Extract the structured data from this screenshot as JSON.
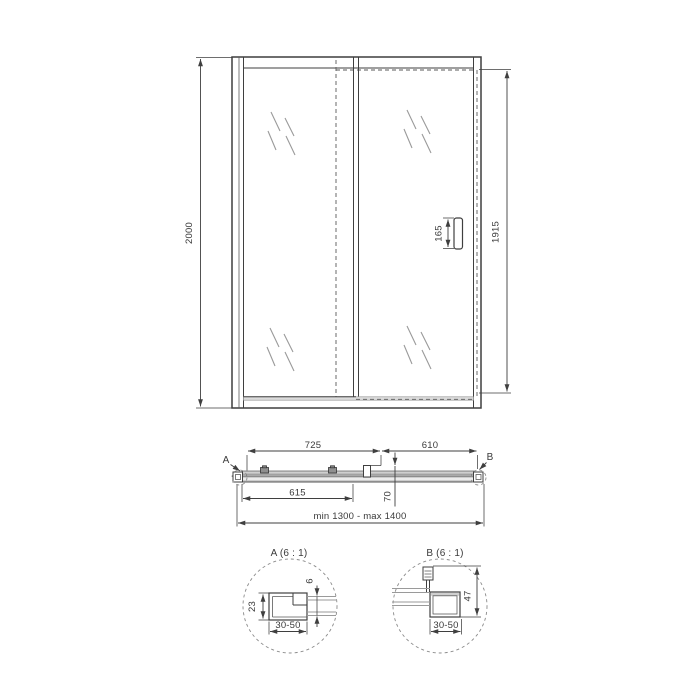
{
  "title": "Sliding shower door in niche — dimensional technical drawing",
  "colors": {
    "background": "#ffffff",
    "line": "#3f3f3f",
    "glass_hatch": "#9a9a9a",
    "fill_light_gray": "#cfcfcf"
  },
  "front": {
    "overall_height": "2000",
    "door_height": "1915",
    "handle_length": "165"
  },
  "plan": {
    "span_left": "725",
    "span_right": "610",
    "glass_width": "615",
    "depth": "70",
    "width_range": "min 1300 - max 1400",
    "marker_a": "A",
    "marker_b": "B"
  },
  "detail_a": {
    "title": "A (6 : 1)",
    "profile_depth": "23",
    "glass_thickness": "6",
    "adjustment_range": "30-50"
  },
  "detail_b": {
    "title": "B (6 : 1)",
    "profile_height": "47",
    "adjustment_range": "30-50"
  }
}
